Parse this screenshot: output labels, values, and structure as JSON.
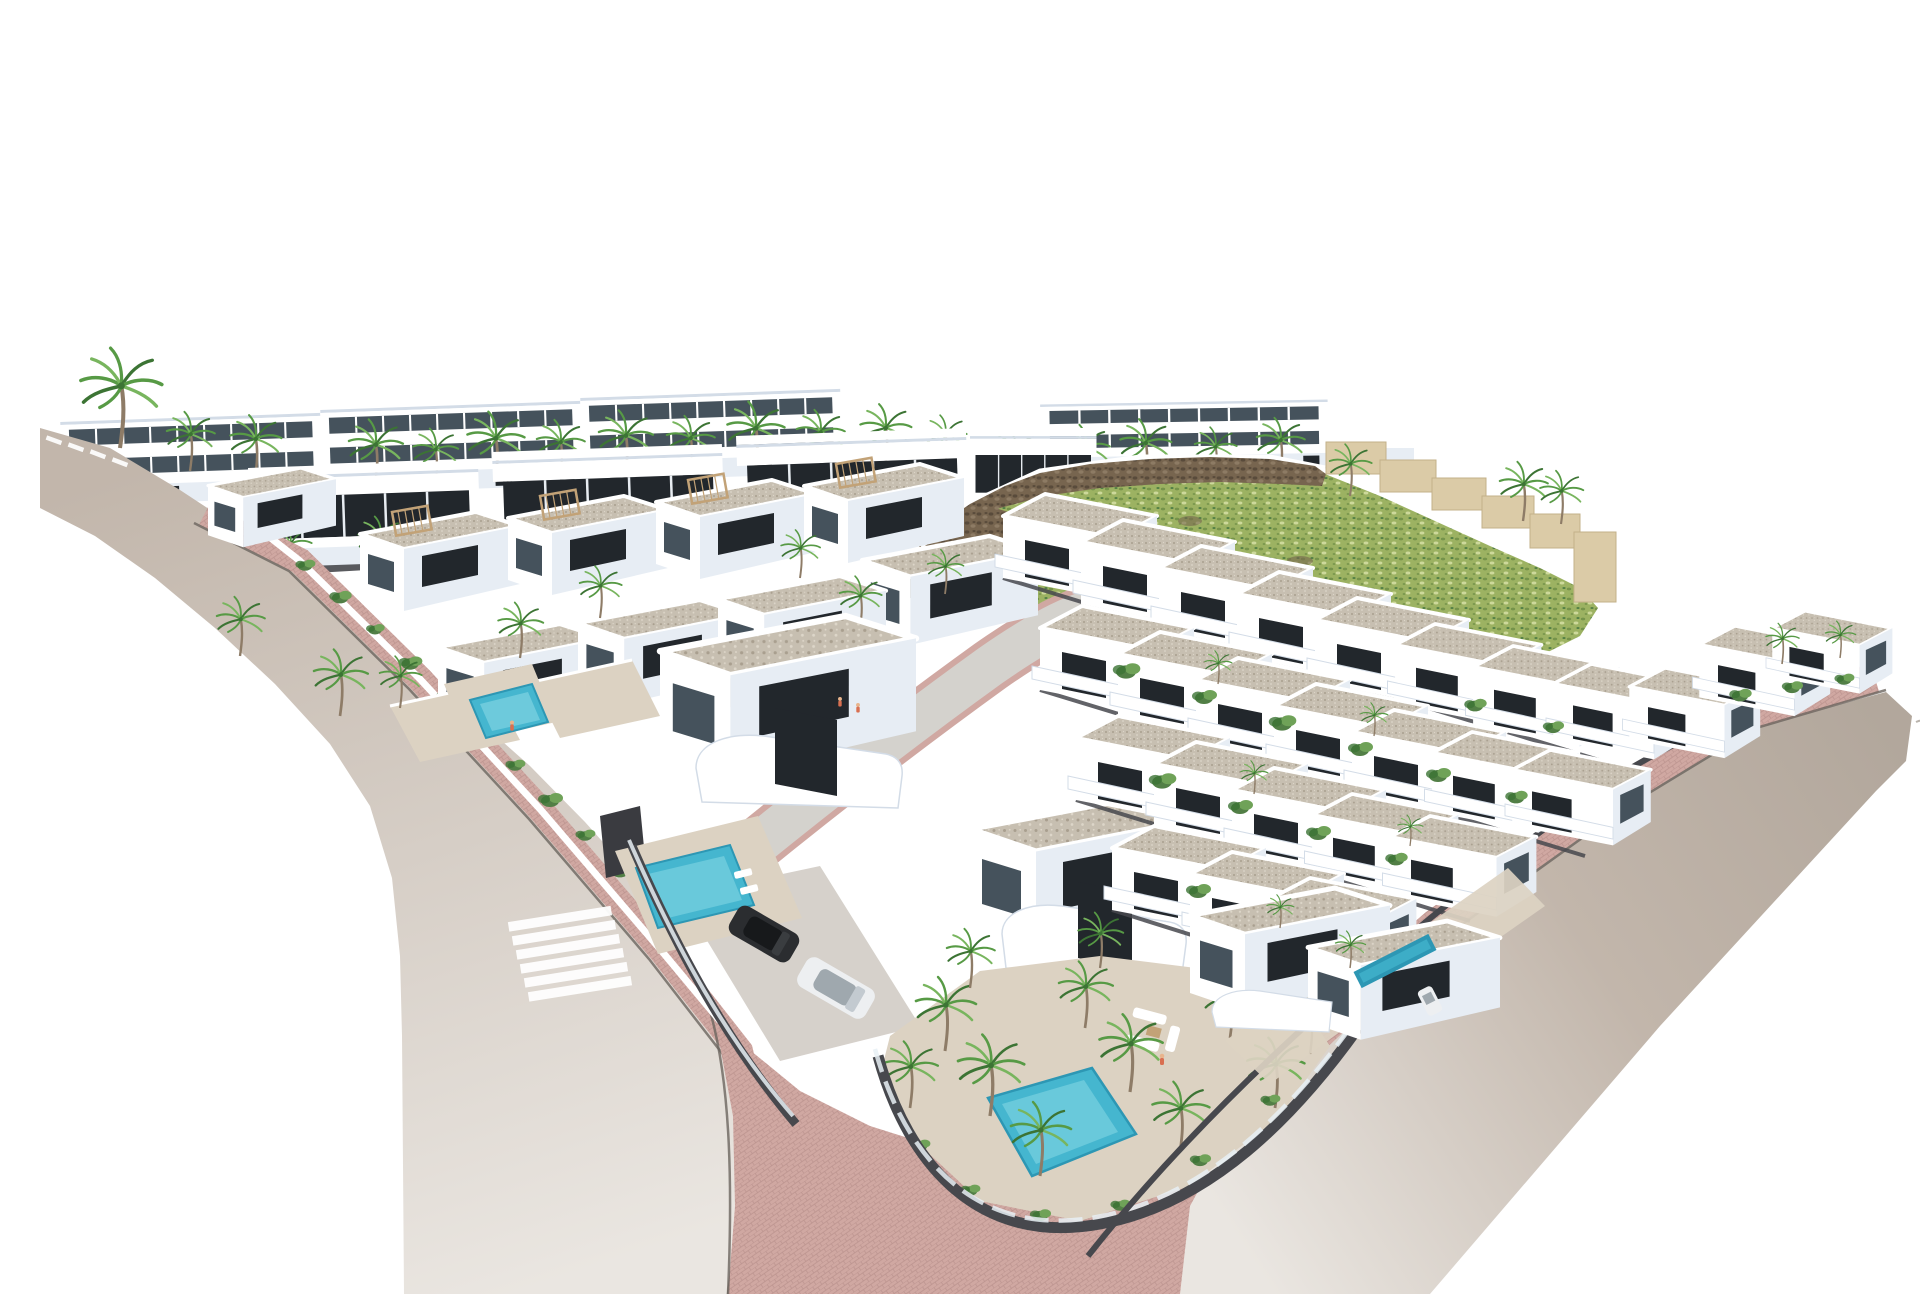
{
  "scene": {
    "type": "architectural_render",
    "view": "aerial_isometric",
    "subject": "Hillside residential development render: rows of white modern villas and apartment blocks with gravel roofs, palm trees, private pools, pink-paved sidewalks and curving streets on a white background",
    "background_color": "#ffffff"
  },
  "palette": {
    "background": "#ffffff",
    "road_asphalt": "#c2b6ab",
    "road_asphalt_light": "#eae6e1",
    "road_asphalt_deep": "#b2a79c",
    "road_access": "#d4d2cd",
    "sidewalk": "#d0a8a2",
    "sidewalk_line": "#bb938e",
    "curb": "#6b655f",
    "house_white": "#ffffff",
    "house_shade1": "#e7edf4",
    "house_shade2": "#d3dce7",
    "house_shade3": "#bfcad7",
    "window_dark": "#22272c",
    "window_mid": "#45525c",
    "roof_gravel": "#c7bfb1",
    "roof_gravel_dark": "#a99f8f",
    "roof_gravel_light": "#ddd6c9",
    "wall_dark": "#47484d",
    "glass_fence": "#e7f0f4",
    "pool_water": "#45b6cf",
    "pool_deep": "#2d97b4",
    "pool_light": "#8edbe8",
    "terrace": "#dcd2c2",
    "pergola": "#c2a277",
    "palm_green": "#579a45",
    "palm_dark": "#3c7434",
    "palm_light": "#78b55e",
    "palm_trunk": "#8e7c67",
    "bush": "#527f46",
    "bush_light": "#6fa258",
    "hill_green": "#9cb262",
    "hill_speckle_dark": "#75934a",
    "hill_speckle_light": "#cdd99b",
    "rock": "#77654f",
    "rock_dark": "#594b3b",
    "stone_wall": "#dbcba7",
    "stone_wall_shade": "#c3b08a",
    "car_dark": "#2b2d30",
    "car_white": "#edeff1",
    "drive": "#d6d1cb",
    "people_skin": "#e8b48c",
    "people_cloth": "#d96f50"
  },
  "inventory": {
    "apartment_blocks_back_row": 4,
    "apartment_blocks_mid_row": 4,
    "detached_villas_left_block": 9,
    "corner_villas": 2,
    "row_houses_right_block": 28,
    "swimming_pools": 4,
    "palm_trees": 60,
    "garden_shrubs": 36,
    "vehicles": 3,
    "people": 4,
    "roads": 3,
    "crosswalk_stripes": 6,
    "lane_marking_dashes": 4,
    "stone_wall_steps": 6
  }
}
